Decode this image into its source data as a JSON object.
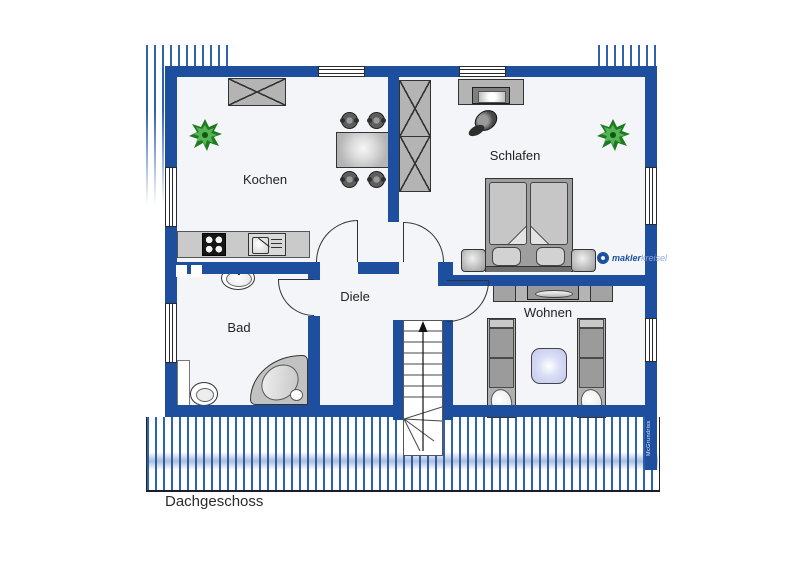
{
  "floor": {
    "title": "Dachgeschoss"
  },
  "rooms": {
    "kochen": {
      "label": "Kochen"
    },
    "schlafen": {
      "label": "Schlafen"
    },
    "bad": {
      "label": "Bad"
    },
    "diele": {
      "label": "Diele"
    },
    "wohnen": {
      "label": "Wohnen"
    }
  },
  "branding": {
    "logo_bold": "makler",
    "logo_light": "kreisel",
    "watermark": "McGrundriss"
  },
  "colors": {
    "wall": "#1e4f9f",
    "stripe": "#2e62b0",
    "floor": "#f3f5f9",
    "outline": "#333333",
    "furniture": "#b4b4b4",
    "furniture-dark": "#8f8f8f",
    "counter": "#cacaca",
    "table-accent": "#c9cdf1",
    "plant": "#2e8b2e",
    "logo-blue": "#1b4f9e",
    "logo-light-blue": "#8fa8d8"
  }
}
